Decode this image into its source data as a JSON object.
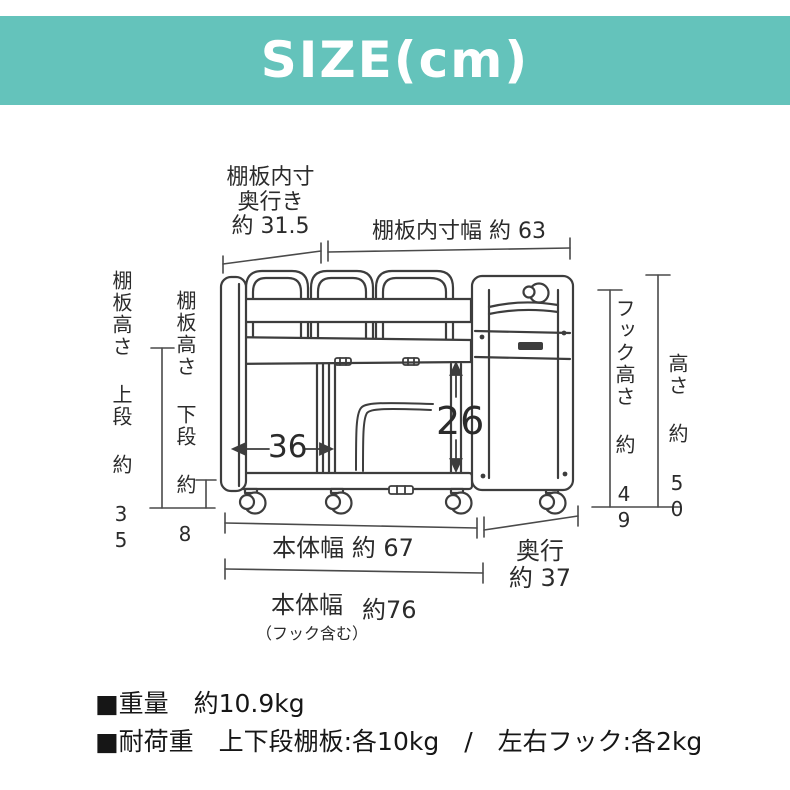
{
  "header": {
    "title": "SIZE(cm)",
    "bg_color": "#64c3bb",
    "text_color": "#ffffff"
  },
  "dimensions": {
    "shelf_inner_depth": {
      "label_line1": "棚板内寸",
      "label_line2": "奥行き",
      "value": "約 31.5"
    },
    "shelf_inner_width": {
      "label": "棚板内寸幅 約 63"
    },
    "shelf_height_upper": {
      "label": "棚板高さ 上段 約 35"
    },
    "shelf_height_lower": {
      "label": "棚板高さ 下段 約 8"
    },
    "hook_height": {
      "label": "フック高さ 約 49"
    },
    "overall_height": {
      "label": "高さ 約 50"
    },
    "lower_inner_width": {
      "value": "36"
    },
    "lower_inner_height": {
      "value": "26"
    },
    "body_width": {
      "label": "本体幅 約 67"
    },
    "depth": {
      "label_line1": "奥行",
      "label_line2": "約 37"
    },
    "body_width_with_hooks": {
      "label": "本体幅",
      "value": "約76",
      "note": "（フック含む）"
    }
  },
  "specs": {
    "weight": "■重量　約10.9kg",
    "load_capacity": "■耐荷重　上下段棚板:各10kg　/　左右フック:各2kg"
  },
  "colors": {
    "line": "#3d3d3d",
    "dimension_line": "#4a4a4a"
  }
}
